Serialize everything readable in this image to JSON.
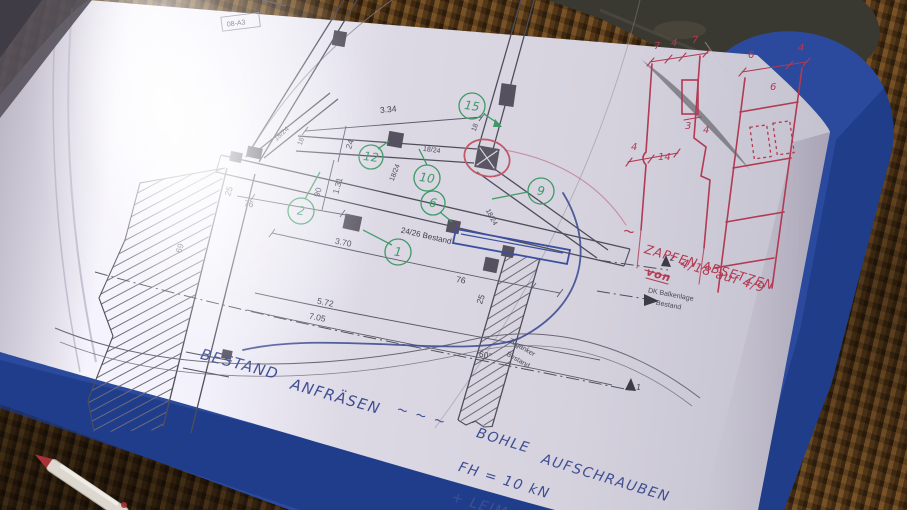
{
  "drawing": {
    "sheet_tag": "08-A3",
    "beam_label": "24/26 Bestand",
    "member_labels": {
      "brace_left": "18/24",
      "rail_block": "18/24",
      "rail": "18/24",
      "brace_right": "18/24"
    },
    "dims": {
      "top_span": "3.34",
      "beam_span": "3.70",
      "lower_span": "5.72",
      "total_span": "7.05",
      "left_offset": "76",
      "right_offset": "76",
      "left_col_width": "25",
      "right_col_width": "25",
      "rail_height": "24",
      "post_spacing": "1.31",
      "post_height": "90",
      "wall_width": "69",
      "end_a": "18",
      "end_b": "18",
      "anchor_angle": "60°"
    },
    "texts": {
      "tie_anchor_1": "Zuganker",
      "tie_anchor_2": "Bestand",
      "level_label_1": "DK Balkenlage",
      "level_label_2": "Bestand",
      "level_marker_2": "2",
      "level_marker_1": "1"
    },
    "callouts": {
      "c1": "1",
      "c2": "2",
      "c6": "6",
      "c9": "9",
      "c10": "10",
      "c12": "12",
      "c15": "15"
    }
  },
  "handwriting": {
    "red": {
      "squiggle": "~",
      "line1": "ZAPFEN ABSETZEN",
      "strike_word": "von",
      "value_change": "4/18 auf 4/9"
    },
    "blue": {
      "word1": "BESTAND",
      "word2": "ANFRÄSEN",
      "squiggle": "~ ~ ~",
      "word3": "BOHLE",
      "word4": "AUFSCHRAUBEN",
      "formula": "FH = 10 kN",
      "addition": "+ LEIM"
    }
  },
  "red_sketch": {
    "left": {
      "top_dims": [
        "7",
        "4",
        "7"
      ],
      "tenon_dims": [
        "3",
        "4"
      ],
      "bottom_dims": [
        "4",
        "14"
      ]
    },
    "right": {
      "top_dims": [
        "6",
        "4"
      ],
      "mid_dim": "6"
    }
  },
  "colors": {
    "binder_blue": "#2b4a9d",
    "red_pen": "#b23a52",
    "blue_pen": "#3f4f92",
    "callout_green": "#3e9a64",
    "mat_brown": "#5e3f1d"
  }
}
